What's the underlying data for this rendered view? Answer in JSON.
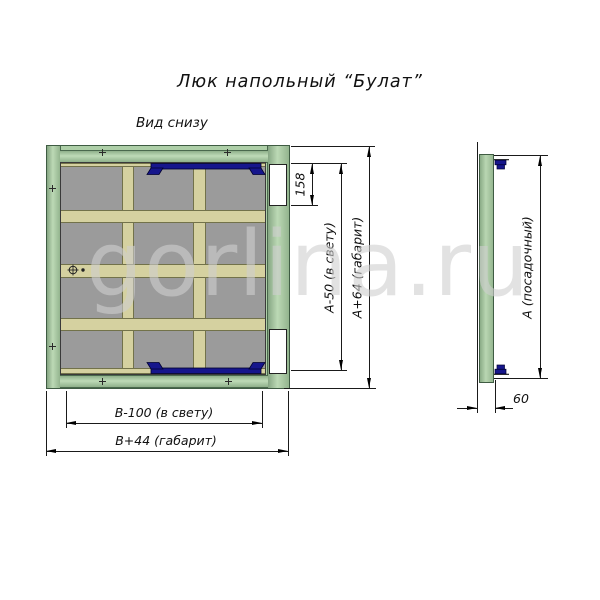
{
  "title": "Люк напольный “Булат”",
  "view_label": "Вид снизу",
  "watermark": "gorlina.ru",
  "dims": {
    "hinge_recess": "158",
    "clear_height": "А-50 (в свету)",
    "overall_height": "А+64 (габарит)",
    "clear_width": "В-100 (в свету)",
    "overall_width": "В+44 (габарит)",
    "seat_height": "А (посадочный)",
    "depth": "60"
  },
  "colors": {
    "frame_green": "#aecfa8",
    "frame_green_dark": "#4a694d",
    "panel_gray": "#9b9b9b",
    "stiffener_beige": "#d5d1a0",
    "hinge_blue": "#16168c",
    "watermark_gray": "#cfcfcf"
  }
}
